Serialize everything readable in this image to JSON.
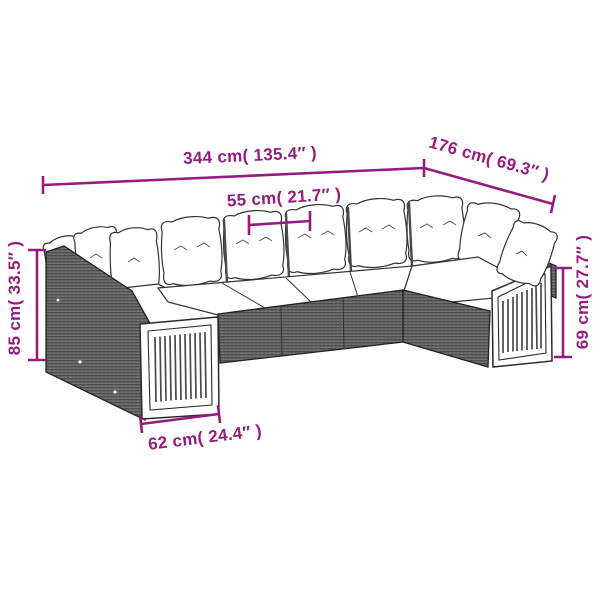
{
  "diagram": {
    "subject": "modular-rattan-garden-sofa-set-line-drawing",
    "background_color": "#ffffff",
    "accent_color": "#951c7f",
    "outline_color": "#2e2e2e",
    "rattan_color": "#6a6a6a",
    "cushion_color": "#ffffff",
    "dimensions": {
      "overall_width": {
        "cm": 344,
        "inches": 135.4,
        "label": "344 cm( 135.4″ )"
      },
      "overall_depth": {
        "cm": 176,
        "inches": 69.3,
        "label": "176 cm( 69.3″ )"
      },
      "seat_module_width": {
        "cm": 55,
        "inches": 21.7,
        "label": "55 cm( 21.7″ )"
      },
      "back_height": {
        "cm": 85,
        "inches": 33.5,
        "label": "85 cm( 33.5″ )"
      },
      "arm_height": {
        "cm": 69,
        "inches": 27.7,
        "label": "69 cm( 27.7″ )"
      },
      "end_section_depth": {
        "cm": 62,
        "inches": 24.4,
        "label": "62 cm( 24.4″ )"
      }
    }
  }
}
